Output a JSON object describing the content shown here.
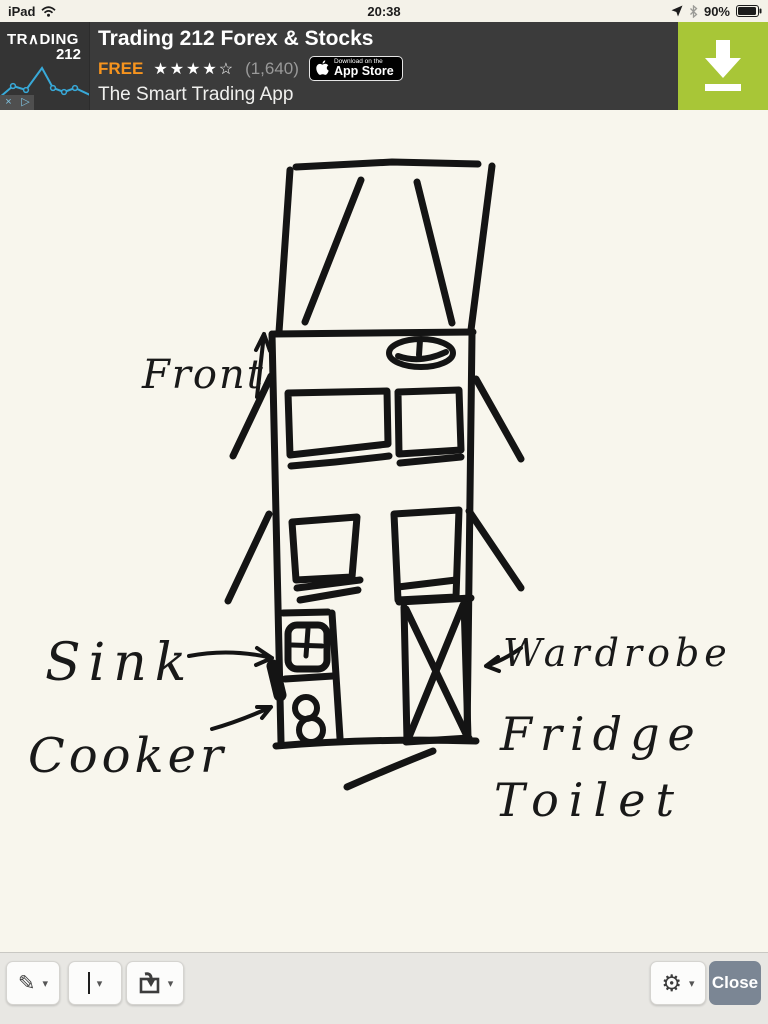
{
  "status_bar": {
    "carrier": "iPad",
    "time": "20:38",
    "battery_percent": "90%"
  },
  "ad_banner": {
    "logo_line1": "TR∧DING",
    "logo_line2": "212",
    "title": "Trading 212 Forex & Stocks",
    "price": "FREE",
    "stars": "★★★★☆",
    "rating_count": "(1,640)",
    "appstore_small": "Download on the",
    "appstore_large": "App Store",
    "tagline": "The Smart Trading App",
    "adchoices_close_glyph": "×",
    "adchoices_play_glyph": "▷",
    "colors": {
      "banner_bg": "#3b3b3b",
      "price_orange": "#f7941e",
      "download_green": "#a8c637",
      "sparkline_blue": "#38a9d8"
    }
  },
  "sketch": {
    "labels": {
      "front": "Front",
      "sink": "Sink",
      "cooker": "Cooker",
      "wardrobe": "Wardrobe",
      "fridge": "Fridge",
      "toilet": "Toilet"
    }
  },
  "toolbar": {
    "pen_glyph": "✎",
    "gear_glyph": "⚙",
    "chevron_glyph": "▾",
    "close_label": "Close"
  }
}
